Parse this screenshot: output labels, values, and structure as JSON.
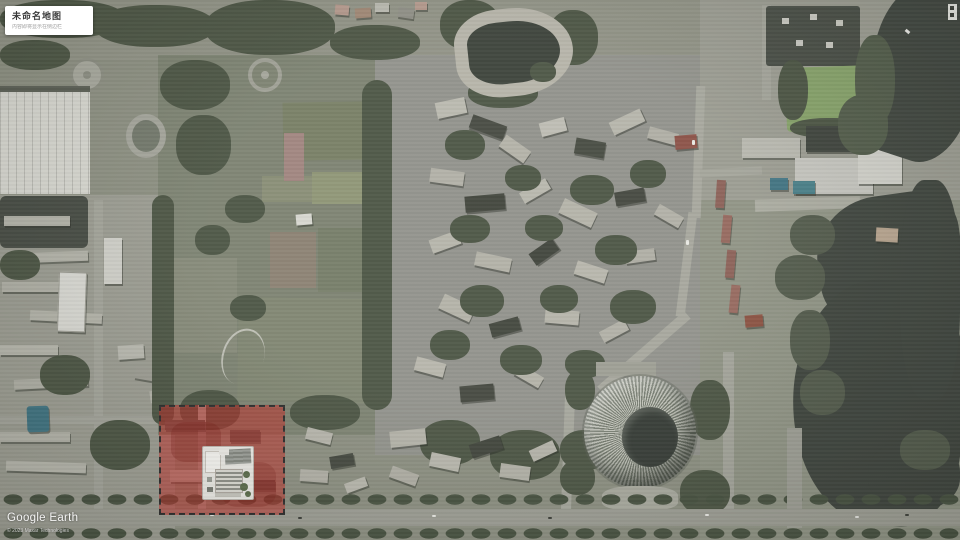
{
  "map_card": {
    "title": "未命名地图",
    "subtitle": "内容即将显示在侧边栏"
  },
  "watermark": {
    "brand": "Google Earth",
    "attribution": "© 2023 Maxar Technologies"
  },
  "map": {
    "type": "satellite-imagery",
    "features": [
      "sports-park",
      "ring-building",
      "torus-building",
      "lake",
      "highlighted-site-overlay",
      "site-plan-inset"
    ],
    "colors": {
      "overlay_red": "#c12720",
      "overlay_border": "#2b2b2b",
      "water": "#3e443d",
      "park_green": "#7b8170",
      "tree_green": "#4a5342",
      "road_gray": "#9c9d93",
      "building_light": "#b3b2a8",
      "building_dark": "#42463d"
    }
  }
}
